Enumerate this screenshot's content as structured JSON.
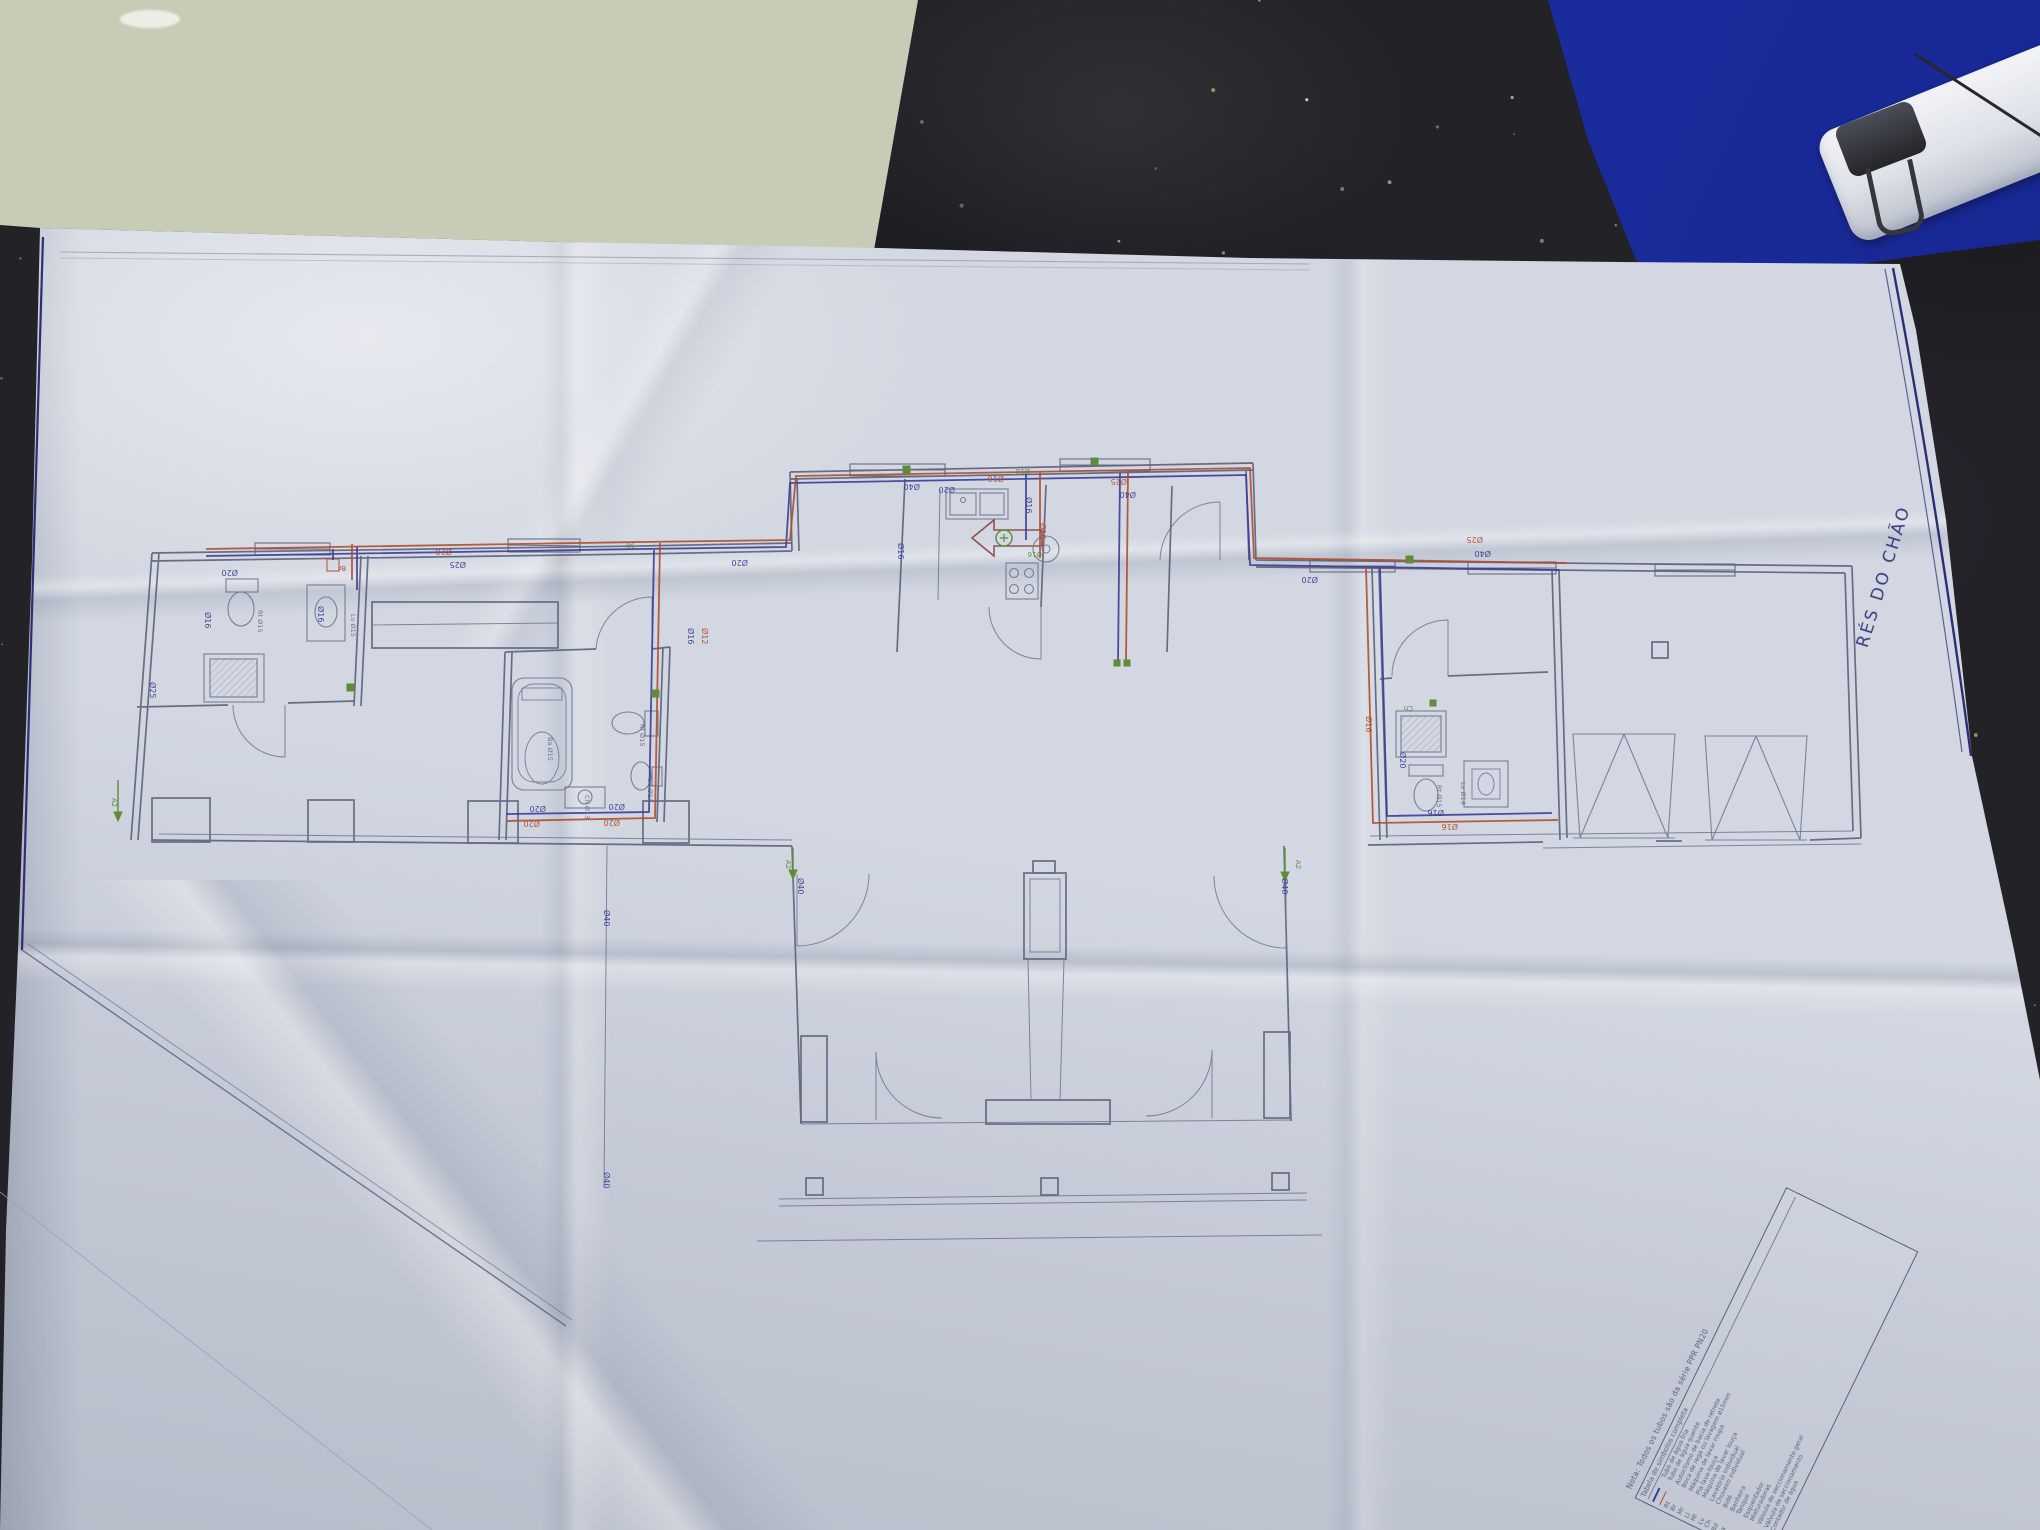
{
  "page": {
    "floor_label": "RÉS DO CHÃO",
    "note": "Nota: Todos os tubos são da série PPR PN20",
    "legend_title": "Tabela de símbolos completa",
    "legend_rows": [
      {
        "symbol": "",
        "swatch": "cold",
        "label": "Tubo de água fria"
      },
      {
        "symbol": "",
        "swatch": "hot",
        "label": "Tubo de água quente"
      },
      {
        "symbol": "Rt",
        "label": "Autoclismo de bacia de retrete"
      },
      {
        "symbol": "Br",
        "label": "Boca de rega ou lavagem ø15mm"
      },
      {
        "symbol": "Mr",
        "label": "Máquina de lavar roupa"
      },
      {
        "symbol": "Ll",
        "label": "Pia lava-louça"
      },
      {
        "symbol": "Ml",
        "label": "Máquina de lavar louça"
      },
      {
        "symbol": "Lv",
        "label": "Lavatório individual"
      },
      {
        "symbol": "Ch",
        "label": "Chuveiro individual"
      },
      {
        "symbol": "Bd",
        "label": "Bidé"
      },
      {
        "symbol": "Ba",
        "label": "Banheira"
      },
      {
        "symbol": "T",
        "label": "Tanque"
      },
      {
        "symbol": "Tt",
        "label": "Esquentador"
      },
      {
        "symbol": "⊞",
        "label": "Misturadoras"
      },
      {
        "symbol": "◆",
        "label": "Válvula de seccionamento geral"
      },
      {
        "symbol": "●",
        "label": "Válvula de seccionamento"
      },
      {
        "symbol": "◉",
        "label": "Contador de água"
      }
    ],
    "colors": {
      "hot": "#b14e2e",
      "cold": "#3d3d96",
      "green": "#5f8c3a",
      "grey": "#6a6f85",
      "wall": "#5c617c",
      "frame": "#2e2e74"
    },
    "pipe_labels": [
      {
        "t": "Ø20",
        "c": "cold",
        "x": 238,
        "y": 570,
        "r": 180
      },
      {
        "t": "Ø16",
        "c": "cold",
        "x": 205,
        "y": 612,
        "r": 90
      },
      {
        "t": "Ø16",
        "c": "cold",
        "x": 318,
        "y": 606,
        "r": 90
      },
      {
        "t": "Br",
        "c": "hot",
        "x": 346,
        "y": 566,
        "r": 180,
        "s": 7
      },
      {
        "t": "Ø25",
        "c": "cold",
        "x": 150,
        "y": 682,
        "r": 90
      },
      {
        "t": "Rt Ø15",
        "c": "grey",
        "x": 258,
        "y": 610,
        "r": 90,
        "s": 6.5
      },
      {
        "t": "Lv Ø15",
        "c": "grey",
        "x": 351,
        "y": 614,
        "r": 90,
        "s": 6.5
      },
      {
        "t": "Ø20",
        "c": "hot",
        "x": 452,
        "y": 549,
        "r": 180
      },
      {
        "t": "Ø25",
        "c": "cold",
        "x": 466,
        "y": 562,
        "r": 180
      },
      {
        "t": "Ml",
        "c": "green",
        "x": 634,
        "y": 543,
        "r": 180,
        "s": 7
      },
      {
        "t": "Ø16",
        "c": "cold",
        "x": 688,
        "y": 628,
        "r": 90
      },
      {
        "t": "Ø12",
        "c": "hot",
        "x": 702,
        "y": 628,
        "r": 90
      },
      {
        "t": "Ø20",
        "c": "cold",
        "x": 748,
        "y": 560,
        "r": 180
      },
      {
        "t": "Ba Ø15",
        "c": "grey",
        "x": 548,
        "y": 737,
        "r": 90,
        "s": 6.5
      },
      {
        "t": "Rt Ø15",
        "c": "grey",
        "x": 640,
        "y": 724,
        "r": 90,
        "s": 6.5
      },
      {
        "t": "Bd Ø14",
        "c": "grey",
        "x": 648,
        "y": 778,
        "r": 90,
        "s": 6.5
      },
      {
        "t": "Ch Ø13",
        "c": "grey",
        "x": 585,
        "y": 795,
        "r": 90,
        "s": 6.5
      },
      {
        "t": "Ø20",
        "c": "cold",
        "x": 546,
        "y": 806,
        "r": 180
      },
      {
        "t": "Ø20",
        "c": "hot",
        "x": 540,
        "y": 821,
        "r": 180
      },
      {
        "t": "Ø20",
        "c": "cold",
        "x": 625,
        "y": 804,
        "r": 180
      },
      {
        "t": "Ø20",
        "c": "hot",
        "x": 620,
        "y": 820,
        "r": 180
      },
      {
        "t": "Ø40",
        "c": "cold",
        "x": 920,
        "y": 484,
        "r": 180
      },
      {
        "t": "Ø20",
        "c": "cold",
        "x": 955,
        "y": 487,
        "r": 180
      },
      {
        "t": "Ø16",
        "c": "hot",
        "x": 1004,
        "y": 476,
        "r": 180
      },
      {
        "t": "Ø16",
        "c": "green",
        "x": 1030,
        "y": 469,
        "r": 180,
        "s": 7
      },
      {
        "t": "Ø16",
        "c": "cold",
        "x": 1026,
        "y": 497,
        "r": 90
      },
      {
        "t": "Ø16",
        "c": "hot",
        "x": 1040,
        "y": 523,
        "r": 90
      },
      {
        "t": "Ø16",
        "c": "green",
        "x": 1042,
        "y": 552,
        "r": 180,
        "s": 7
      },
      {
        "t": "Ø16",
        "c": "cold",
        "x": 898,
        "y": 543,
        "r": 90
      },
      {
        "t": "Ø25",
        "c": "hot",
        "x": 1127,
        "y": 479,
        "r": 180
      },
      {
        "t": "Ø40",
        "c": "cold",
        "x": 1136,
        "y": 492,
        "r": 180
      },
      {
        "t": "Ø20",
        "c": "cold",
        "x": 1318,
        "y": 577,
        "r": 180
      },
      {
        "t": "Ø25",
        "c": "hot",
        "x": 1483,
        "y": 537,
        "r": 180
      },
      {
        "t": "Ø40",
        "c": "cold",
        "x": 1491,
        "y": 551,
        "r": 180
      },
      {
        "t": "Ø16",
        "c": "hot",
        "x": 1366,
        "y": 716,
        "r": 90
      },
      {
        "t": "Ø20",
        "c": "cold",
        "x": 1400,
        "y": 752,
        "r": 90
      },
      {
        "t": "Ch",
        "c": "green",
        "x": 1413,
        "y": 706,
        "r": 180,
        "s": 7
      },
      {
        "t": "Rt Ø15",
        "c": "grey",
        "x": 1437,
        "y": 785,
        "r": 90,
        "s": 6.5
      },
      {
        "t": "Lv Ø14",
        "c": "grey",
        "x": 1461,
        "y": 782,
        "r": 90,
        "s": 6.5
      },
      {
        "t": "Ø16",
        "c": "cold",
        "x": 1444,
        "y": 810,
        "r": 180
      },
      {
        "t": "Ø16",
        "c": "hot",
        "x": 1458,
        "y": 824,
        "r": 180
      },
      {
        "t": "Ø40",
        "c": "cold",
        "x": 604,
        "y": 910,
        "r": 90
      },
      {
        "t": "Ø40",
        "c": "cold",
        "x": 604,
        "y": 1172,
        "r": 90
      },
      {
        "t": "A2",
        "c": "green",
        "x": 112,
        "y": 798,
        "r": 90,
        "s": 7
      },
      {
        "t": "A2",
        "c": "green",
        "x": 786,
        "y": 860,
        "r": 90,
        "s": 7
      },
      {
        "t": "A2",
        "c": "green",
        "x": 1296,
        "y": 860,
        "r": 90,
        "s": 7
      },
      {
        "t": "Ø40",
        "c": "cold",
        "x": 798,
        "y": 878,
        "r": 90
      },
      {
        "t": "Ø40",
        "c": "cold",
        "x": 1282,
        "y": 878,
        "r": 90
      }
    ]
  }
}
